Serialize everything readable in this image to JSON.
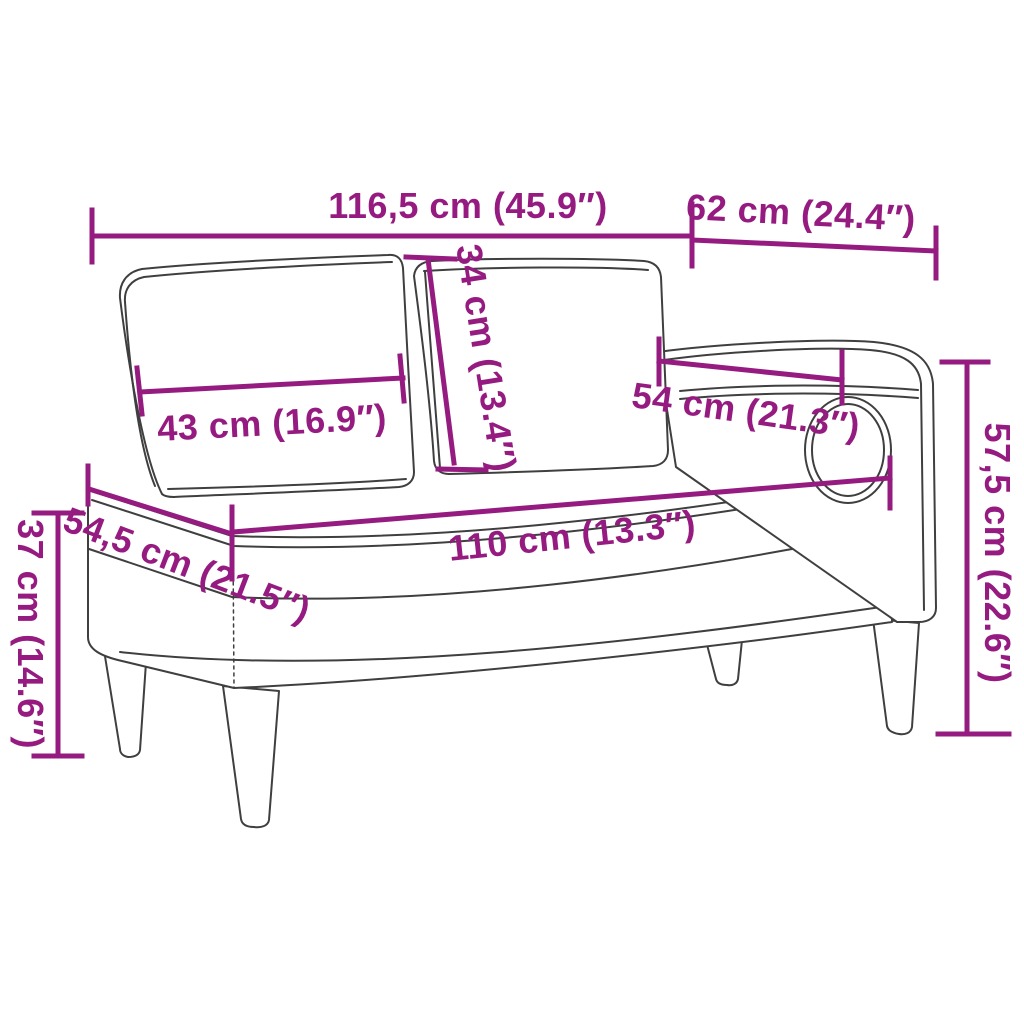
{
  "diagram": {
    "type": "product-dimension-diagram",
    "subject": "chaise-longue-with-cushions-and-bolster",
    "background_color": "#FFFFFF",
    "accent_color": "#951B81",
    "line_art_color": "#3F3F3F",
    "dimensions": [
      {
        "id": "total-width",
        "label": "116,5 cm (45.9″)",
        "cm": "116,5",
        "inches": "45.9"
      },
      {
        "id": "armrest-side-width",
        "label": "62 cm (24.4″)",
        "cm": "62",
        "inches": "24.4"
      },
      {
        "id": "back-cushion-height",
        "label": "34 cm (13.4″)",
        "cm": "34",
        "inches": "13.4"
      },
      {
        "id": "back-cushion-width",
        "label": "43 cm (16.9″)",
        "cm": "43",
        "inches": "16.9"
      },
      {
        "id": "armrest-length",
        "label": "54 cm (21.3″)",
        "cm": "54",
        "inches": "21.3"
      },
      {
        "id": "seat-length",
        "label": "110 cm (13.3″)",
        "cm": "110",
        "inches": "13.3"
      },
      {
        "id": "seat-depth",
        "label": "54,5 cm (21.5″)",
        "cm": "54,5",
        "inches": "21.5"
      },
      {
        "id": "seat-height",
        "label": "37 cm (14.6″)",
        "cm": "37",
        "inches": "14.6"
      },
      {
        "id": "total-height",
        "label": "57,5 cm (22.6″)",
        "cm": "57,5",
        "inches": "22.6"
      }
    ]
  }
}
